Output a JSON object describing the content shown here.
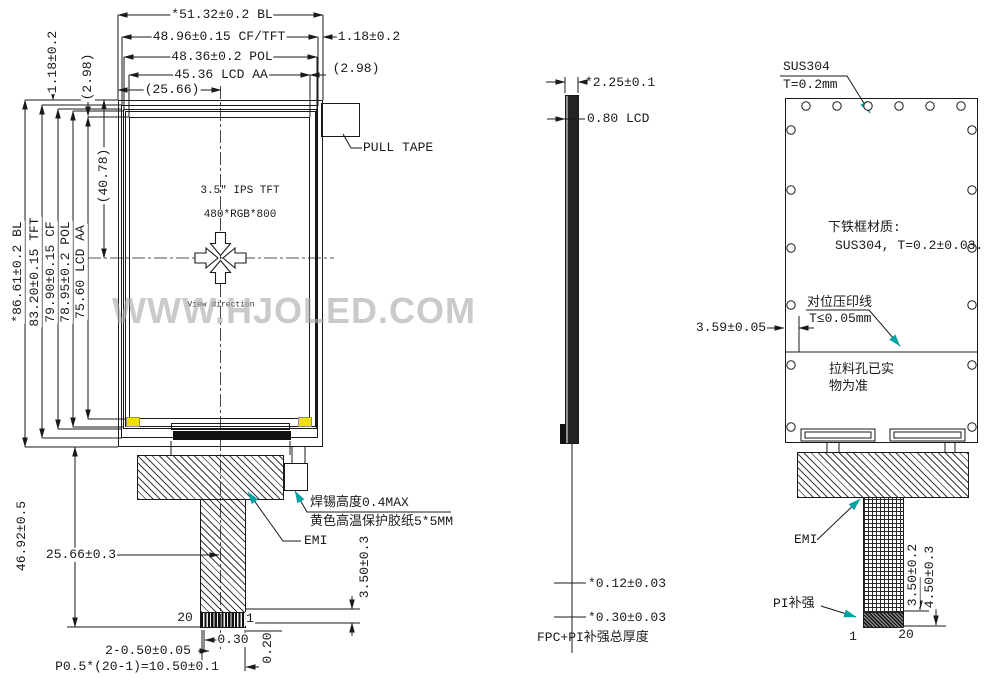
{
  "watermark": "WWW.HJOLED.COM",
  "front": {
    "top_dims": {
      "bl": "*51.32±0.2 BL",
      "cftft": "48.96±0.15 CF/TFT",
      "pol": "48.36±0.2 POL",
      "aa": "45.36 LCD AA",
      "half": "(25.66)",
      "right_offset": "1.18±0.2",
      "right_half": "(2.98)"
    },
    "left_dims": {
      "top_offset": "1.18±0.2",
      "top_half": "(2.98)",
      "bl": "*86.61±0.2 BL",
      "tft": "83.20±0.15 TFT",
      "cf": "79.90±0.15 CF",
      "pol": "78.95±0.2 POL",
      "aa": "75.60 LCD AA",
      "half": "(40.78)"
    },
    "panel": {
      "line1": "3.5\" IPS TFT",
      "line2": "480*RGB*800",
      "view_direction": "View direction"
    },
    "pull_tape_label": "PULL TAPE",
    "notes": {
      "solder": "焊锡高度0.4MAX",
      "tape": "黄色高温保护胶纸5*5MM",
      "emi": "EMI"
    },
    "bottom_dims": {
      "height": "46.92±0.5",
      "center": "25.66±0.3",
      "stiffener": "3.50±0.3",
      "gap": "0.20",
      "pin_width": "0.30",
      "end_pins": "2-0.50±0.05",
      "pitch": "P0.5*(20-1)=10.50±0.1",
      "pin_left": "20",
      "pin_right": "1"
    }
  },
  "side": {
    "total": "*2.25±0.1",
    "lcd": "0.80 LCD",
    "fpc": "*0.12±0.03",
    "pi": "*0.30±0.03",
    "caption": "FPC+PI补强总厚度"
  },
  "back": {
    "frame": "SUS304",
    "frame_t": "T=0.2mm",
    "material1": "下铁框材质:",
    "material2": "SUS304, T=0.2±0.03.",
    "align1": "对位压印线",
    "align2": "T≤0.05mm",
    "inset": "3.59±0.05",
    "hole_note1": "拉料孔已实",
    "hole_note2": "物为准",
    "emi": "EMI",
    "pi": "PI补强",
    "stiffener": "3.50±0.2",
    "total": "4.50±0.3",
    "pin_left": "1",
    "pin_right": "20"
  }
}
